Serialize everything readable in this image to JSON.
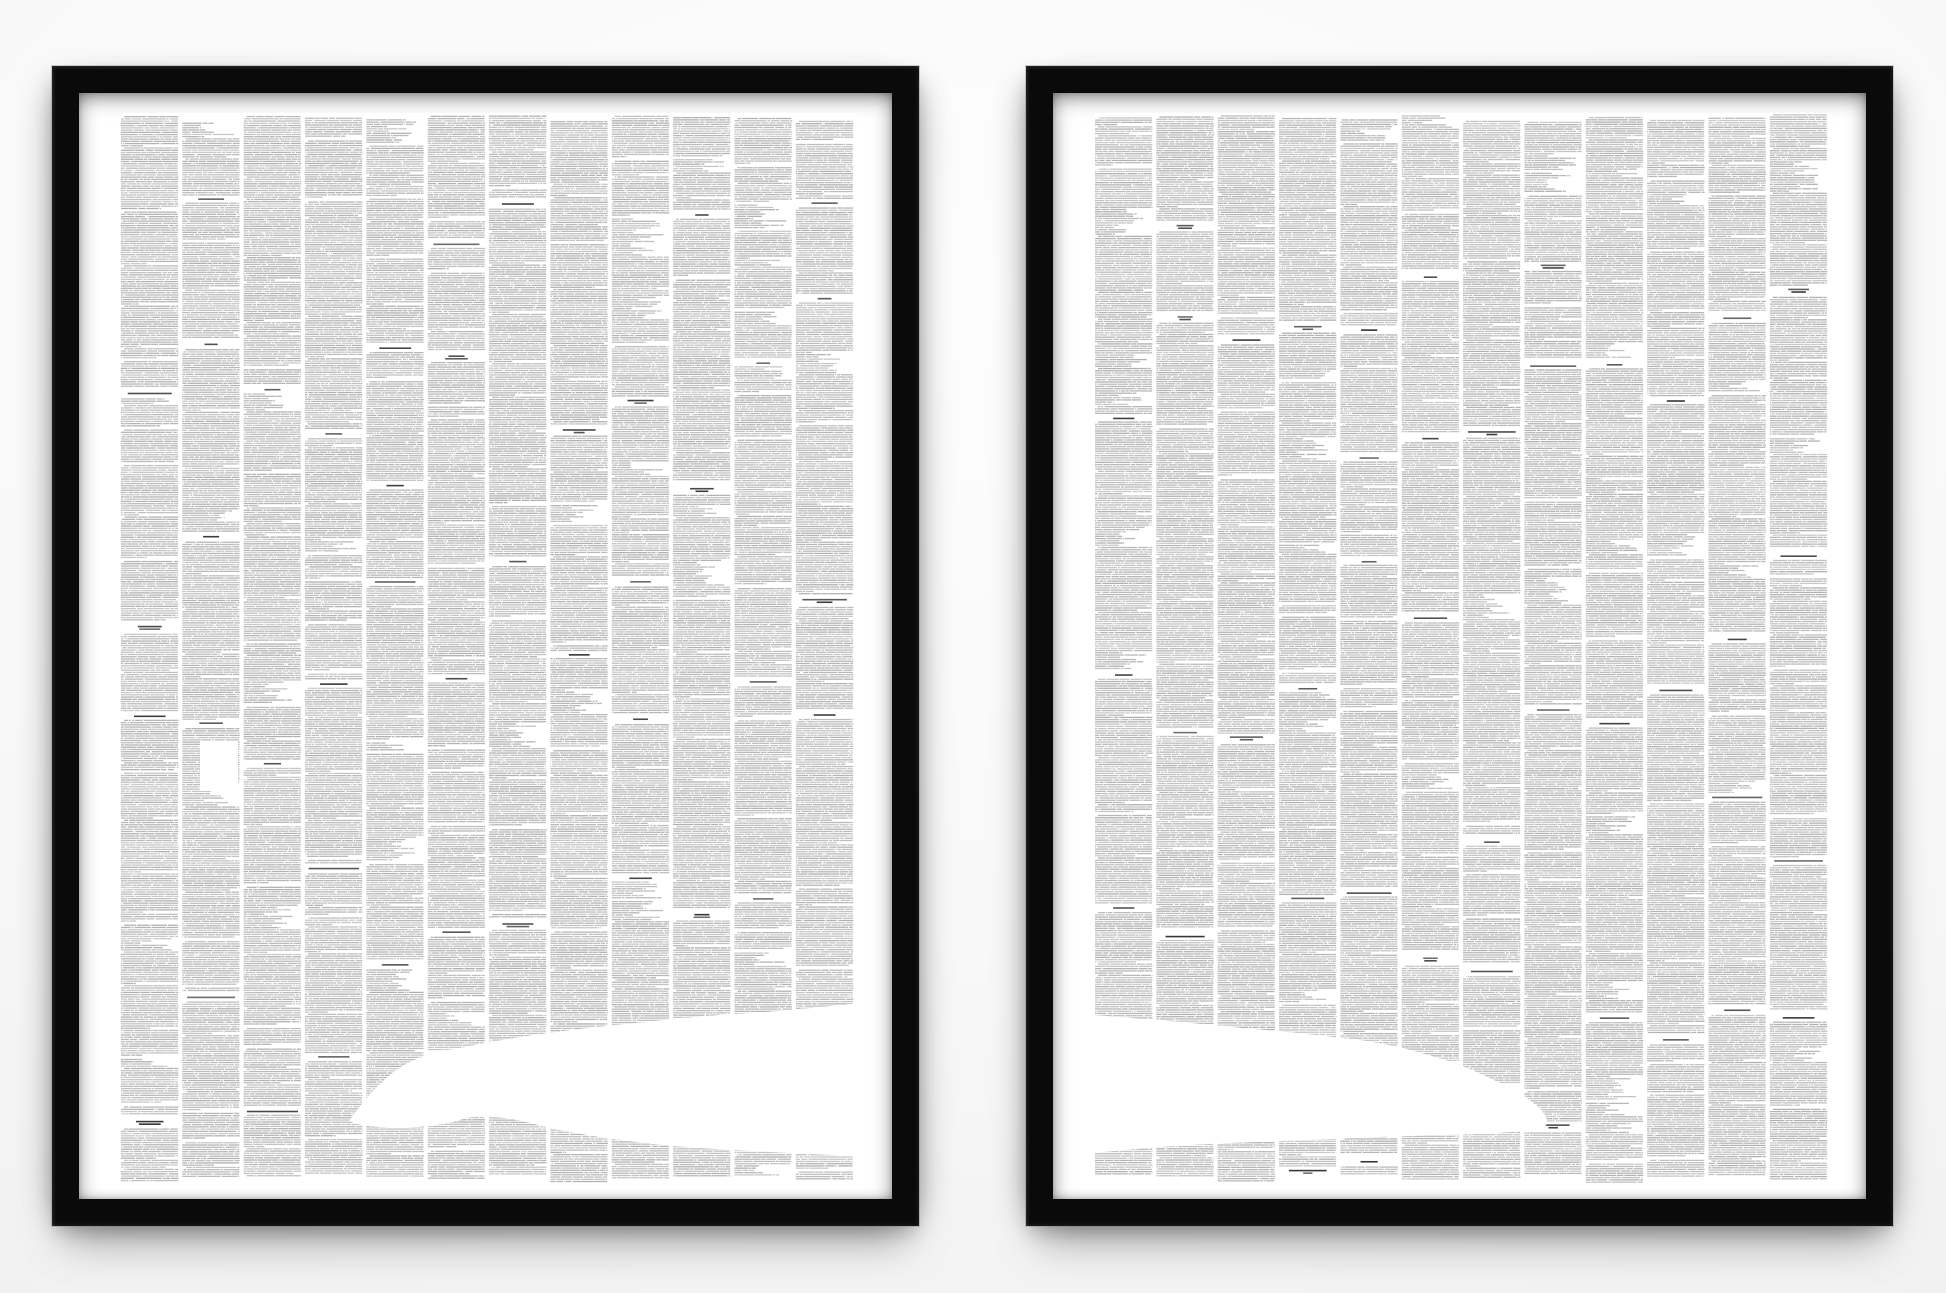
{
  "scene": {
    "description": "Two black-framed art prints hang side by side on a white wall. Each print contains twelve dense columns of unreadable micro-type (the full text of a book) with darker centered chapter headings. The white negative space across the bottom of the two prints forms a whale silhouette swimming right: the thin tail tip on the left print, the body and rounded head on the right print.",
    "wall": {
      "base": "#fdfdfd",
      "mid": "#f8f8f8",
      "edge": "#eeeeee"
    },
    "frame": {
      "color": "#0a0a0a",
      "mat_color": "#ffffff"
    },
    "paper_color": "#ffffff"
  },
  "texture": {
    "print_width": 736,
    "print_height": 1071,
    "col_pitch": 61.35,
    "col_width": 57.5,
    "line_pitch": 2.24,
    "body_line_height": 1.3,
    "heading_line_height": 1.6,
    "body_alpha_min": 0.21,
    "body_alpha_max": 0.31,
    "heading_alpha_min": 0.55,
    "heading_alpha_max": 0.8,
    "dialog_paragraph_probability": 0.085,
    "blank_after_paragraph_probability": 0.22
  },
  "posters": [
    {
      "id": "left",
      "name": "left-print-whale-tail-half",
      "seed": 1851,
      "columns": 12,
      "silhouette_path": "M 228,1008 C 250,977 271,956 293,947 C 315,938 327,937 339,935 C 368,929 397,924 427,920 C 456,916 484,913 514,910 C 552,906 590,902 629,900 C 665,898 709,893 738,890 L 738,1044 C 700,1041 665,1040 629,1038 C 600,1036 571,1035 542,1032 C 512,1029 484,1025 455,1020 C 428,1016 401,1006 374,1004 C 362,1003 350,1003 339,1007 C 318,1013 291,1016 258,1014 C 244,1013 234,1011 228,1008 Z",
      "white_gaps": [
        {
          "x": 79,
          "y": 628,
          "w": 38,
          "h": 50
        }
      ]
    },
    {
      "id": "right",
      "name": "right-print-whale-head-half",
      "seed": 2851,
      "columns": 12,
      "silhouette_path": "M -2,902 C 50,906 100,910 148,915 C 185,918 221,922 257,926 C 282,929 306,934 330,941 C 349,946 367,952 384,960 C 401,968 419,976 432,985 C 443,993 451,1000 452,1008 C 453,1013 448,1016 437,1017 C 426,1019 414,1019 403,1020 C 355,1022 306,1023 258,1025 C 210,1027 161,1029 113,1031 C 75,1033 38,1036 -2,1040 Z",
      "white_gaps": []
    }
  ]
}
